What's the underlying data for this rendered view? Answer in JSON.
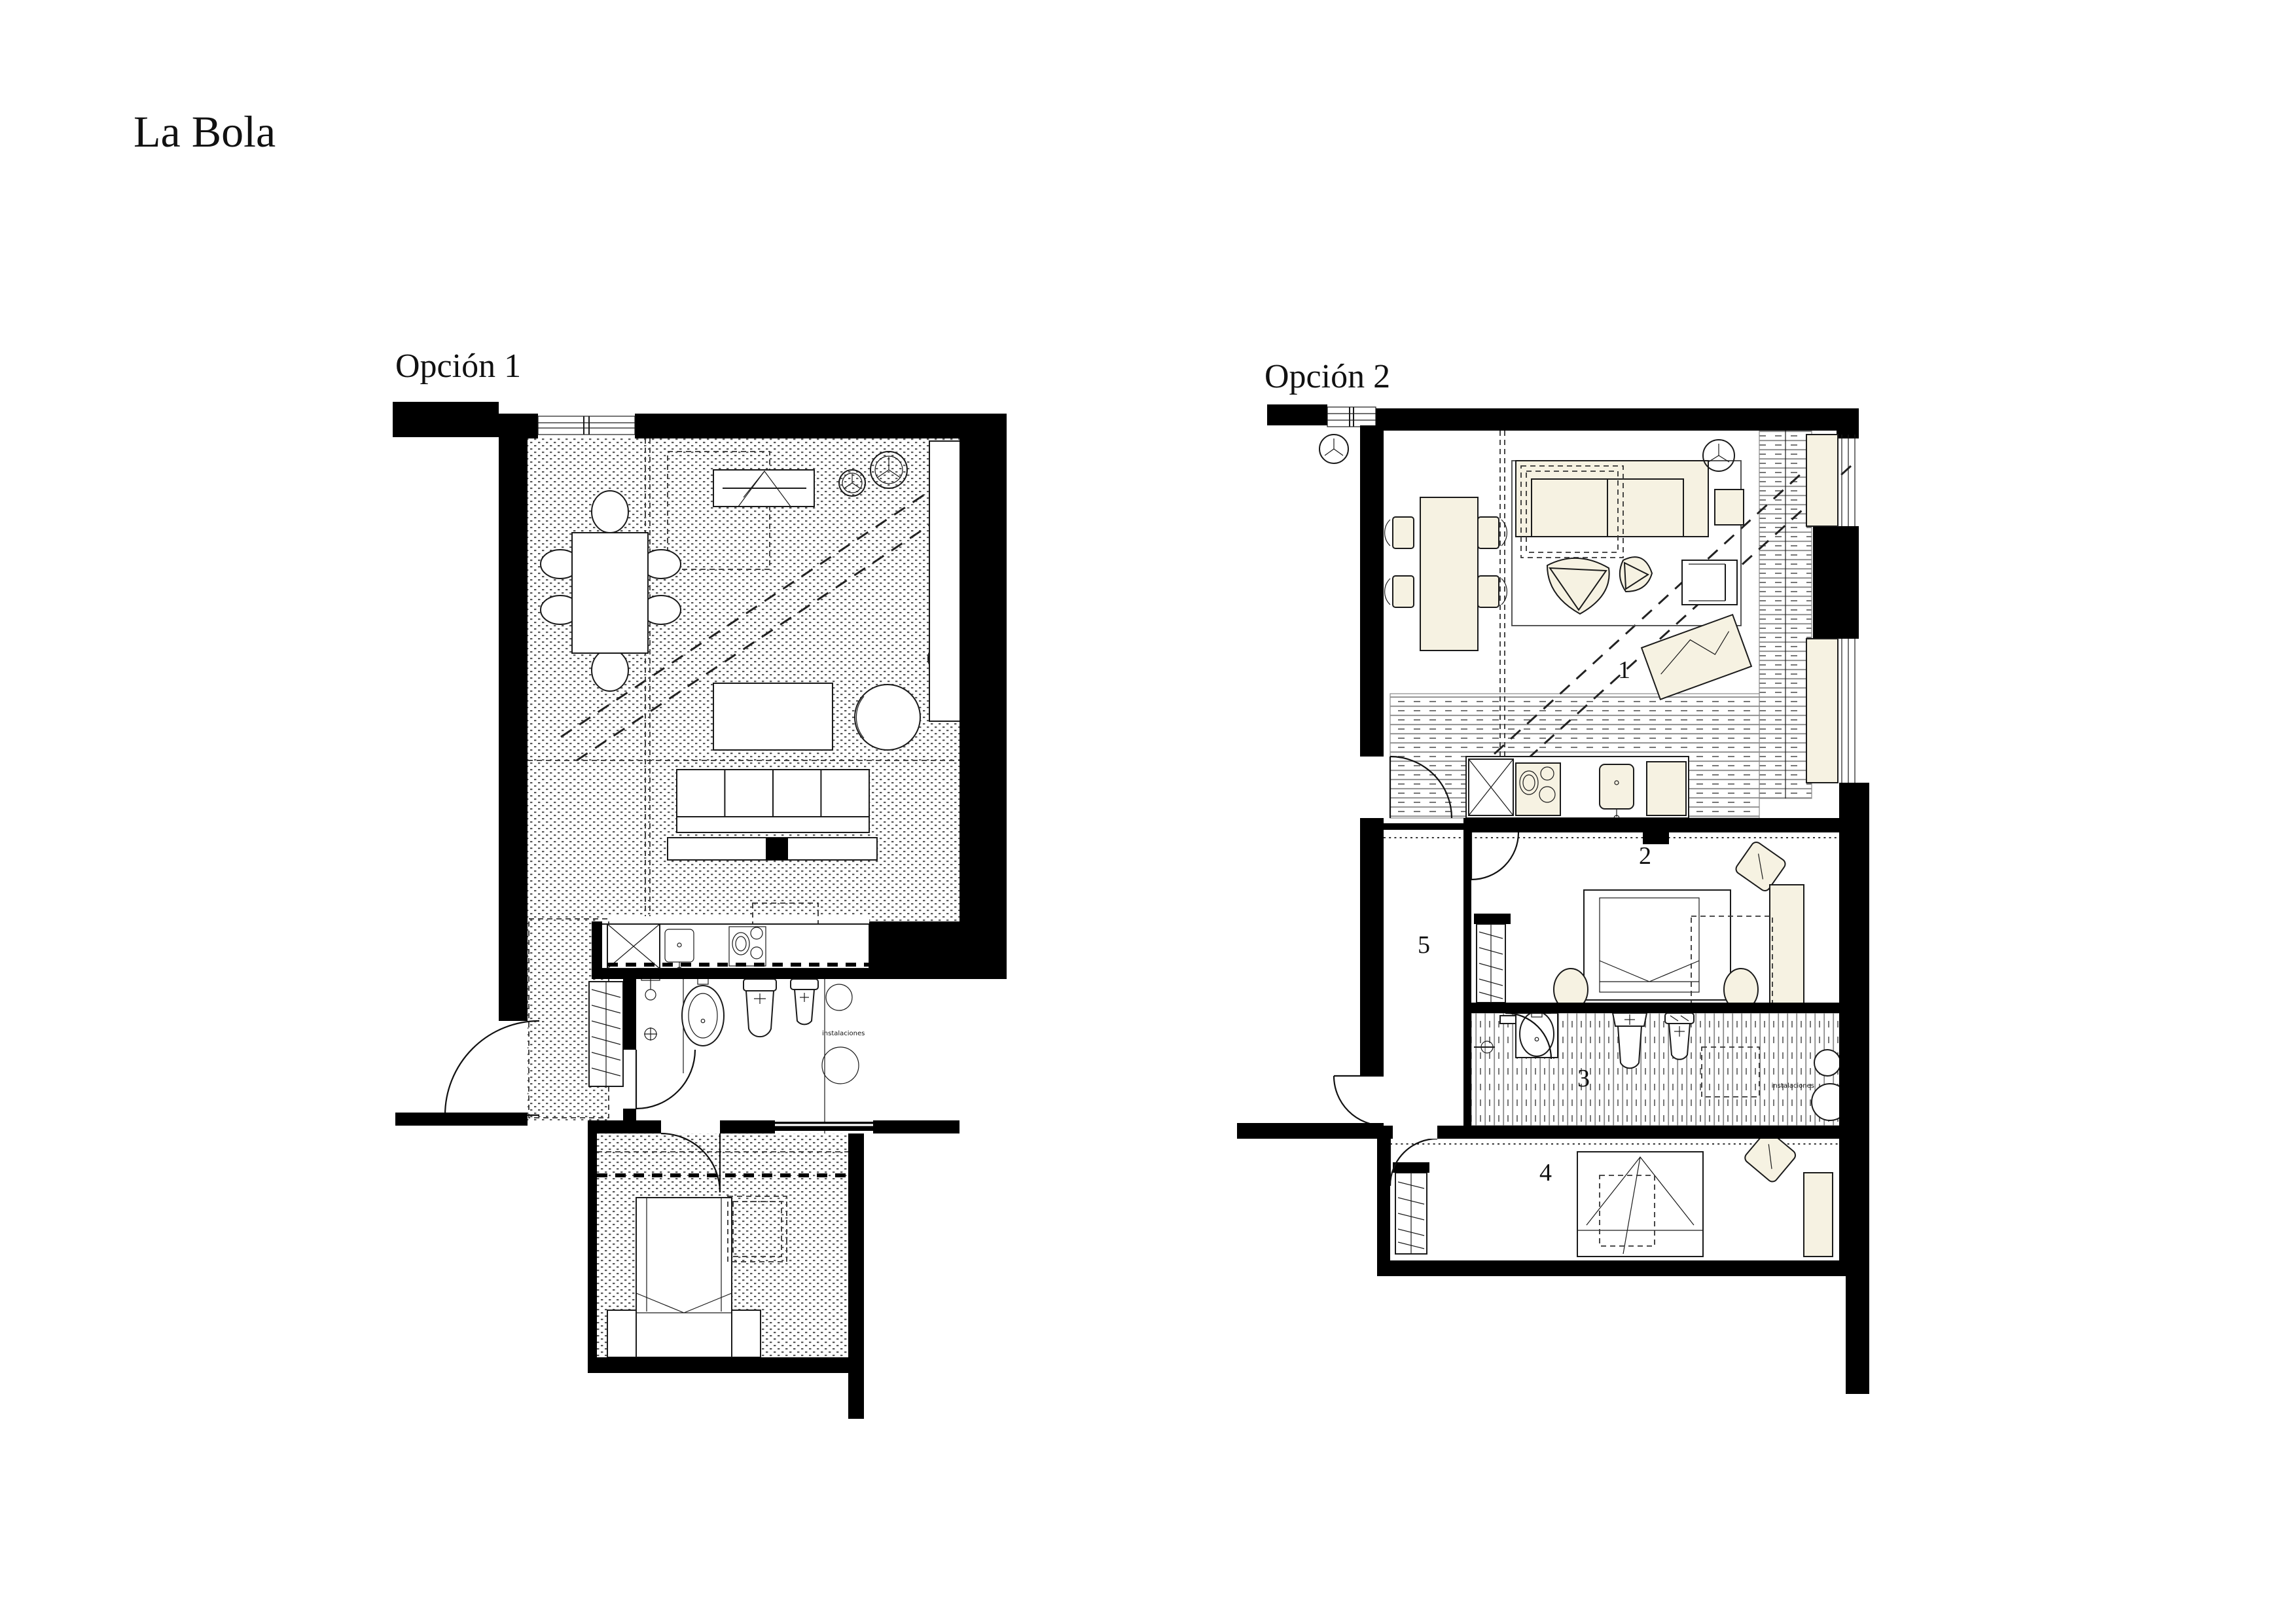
{
  "title": {
    "text": "La Bola"
  },
  "plan1": {
    "label": "Opción 1",
    "utility_label": "instalaciones",
    "rooms": [
      "living-dining",
      "kitchen",
      "bathroom",
      "hall",
      "bedroom"
    ]
  },
  "plan2": {
    "label": "Opción 2",
    "utility_label": "instalaciones",
    "rooms": [
      {
        "number": "1",
        "name": "living-dining"
      },
      {
        "number": "2",
        "name": "bedroom-main"
      },
      {
        "number": "3",
        "name": "bathroom"
      },
      {
        "number": "4",
        "name": "bedroom-second"
      },
      {
        "number": "5",
        "name": "hallway"
      }
    ]
  },
  "colors": {
    "paper": "#ffffff",
    "wall": "#000000",
    "furniture_fill": "#f6f2e2",
    "hatch": "#3a3a3a",
    "dash": "#222222"
  }
}
